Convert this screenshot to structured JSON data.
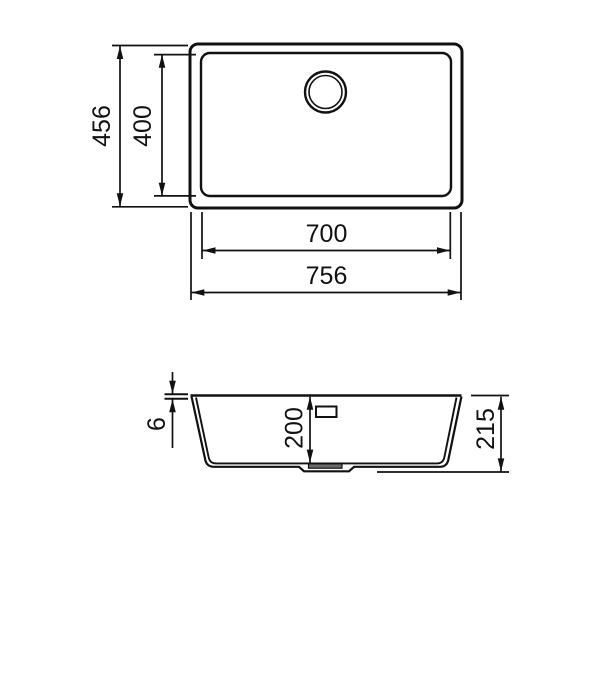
{
  "drawing": {
    "type": "sink-dimension-drawing",
    "background": "#ffffff",
    "line_color": "#111111",
    "drain_fill": "#6a6a6a"
  },
  "top_view": {
    "dims": {
      "overall_depth": "456",
      "bowl_depth": "400",
      "bowl_width": "700",
      "overall_width": "756"
    }
  },
  "section_view": {
    "dims": {
      "rim_height": "6",
      "bowl_depth": "200",
      "overall_height": "215"
    }
  }
}
